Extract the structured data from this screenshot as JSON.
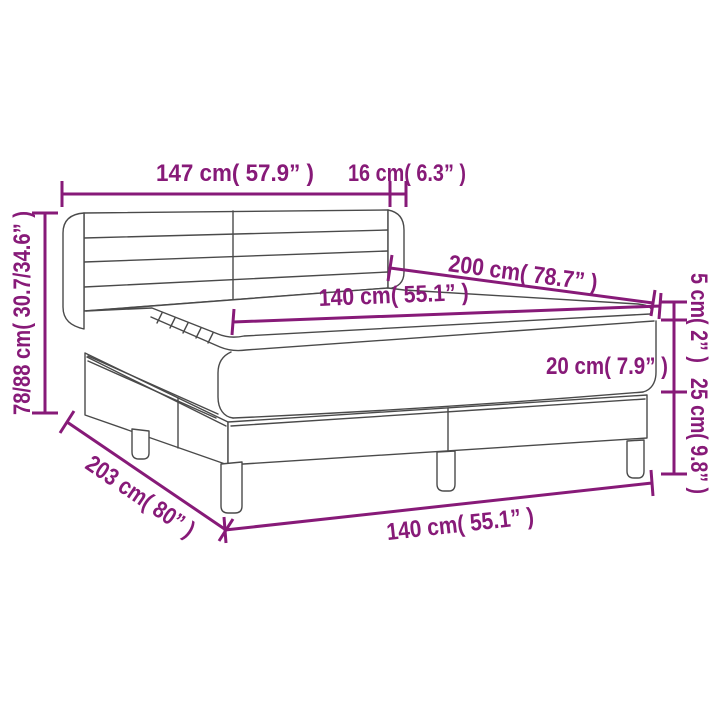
{
  "diagram": {
    "kind": "bed-dimension-diagram",
    "accent_color": "#871a78",
    "drawing_line_color": "#4a4a4a",
    "background_color": "#ffffff",
    "labels": {
      "headboard_width": "147 cm( 57.9” )",
      "wing_depth": "16 cm( 6.3” )",
      "bed_length": "200 cm( 78.7” )",
      "mattress_width": "140 cm( 55.1” )",
      "topper_height": "5 cm( 2” )",
      "mattress_height": "20 cm( 7.9” )",
      "base_height": "25 cm( 9.8” )",
      "overall_height": "78/88 cm( 30.7/34.6” )",
      "base_length": "203 cm( 80” )",
      "base_width": "140 cm( 55.1” )"
    }
  }
}
